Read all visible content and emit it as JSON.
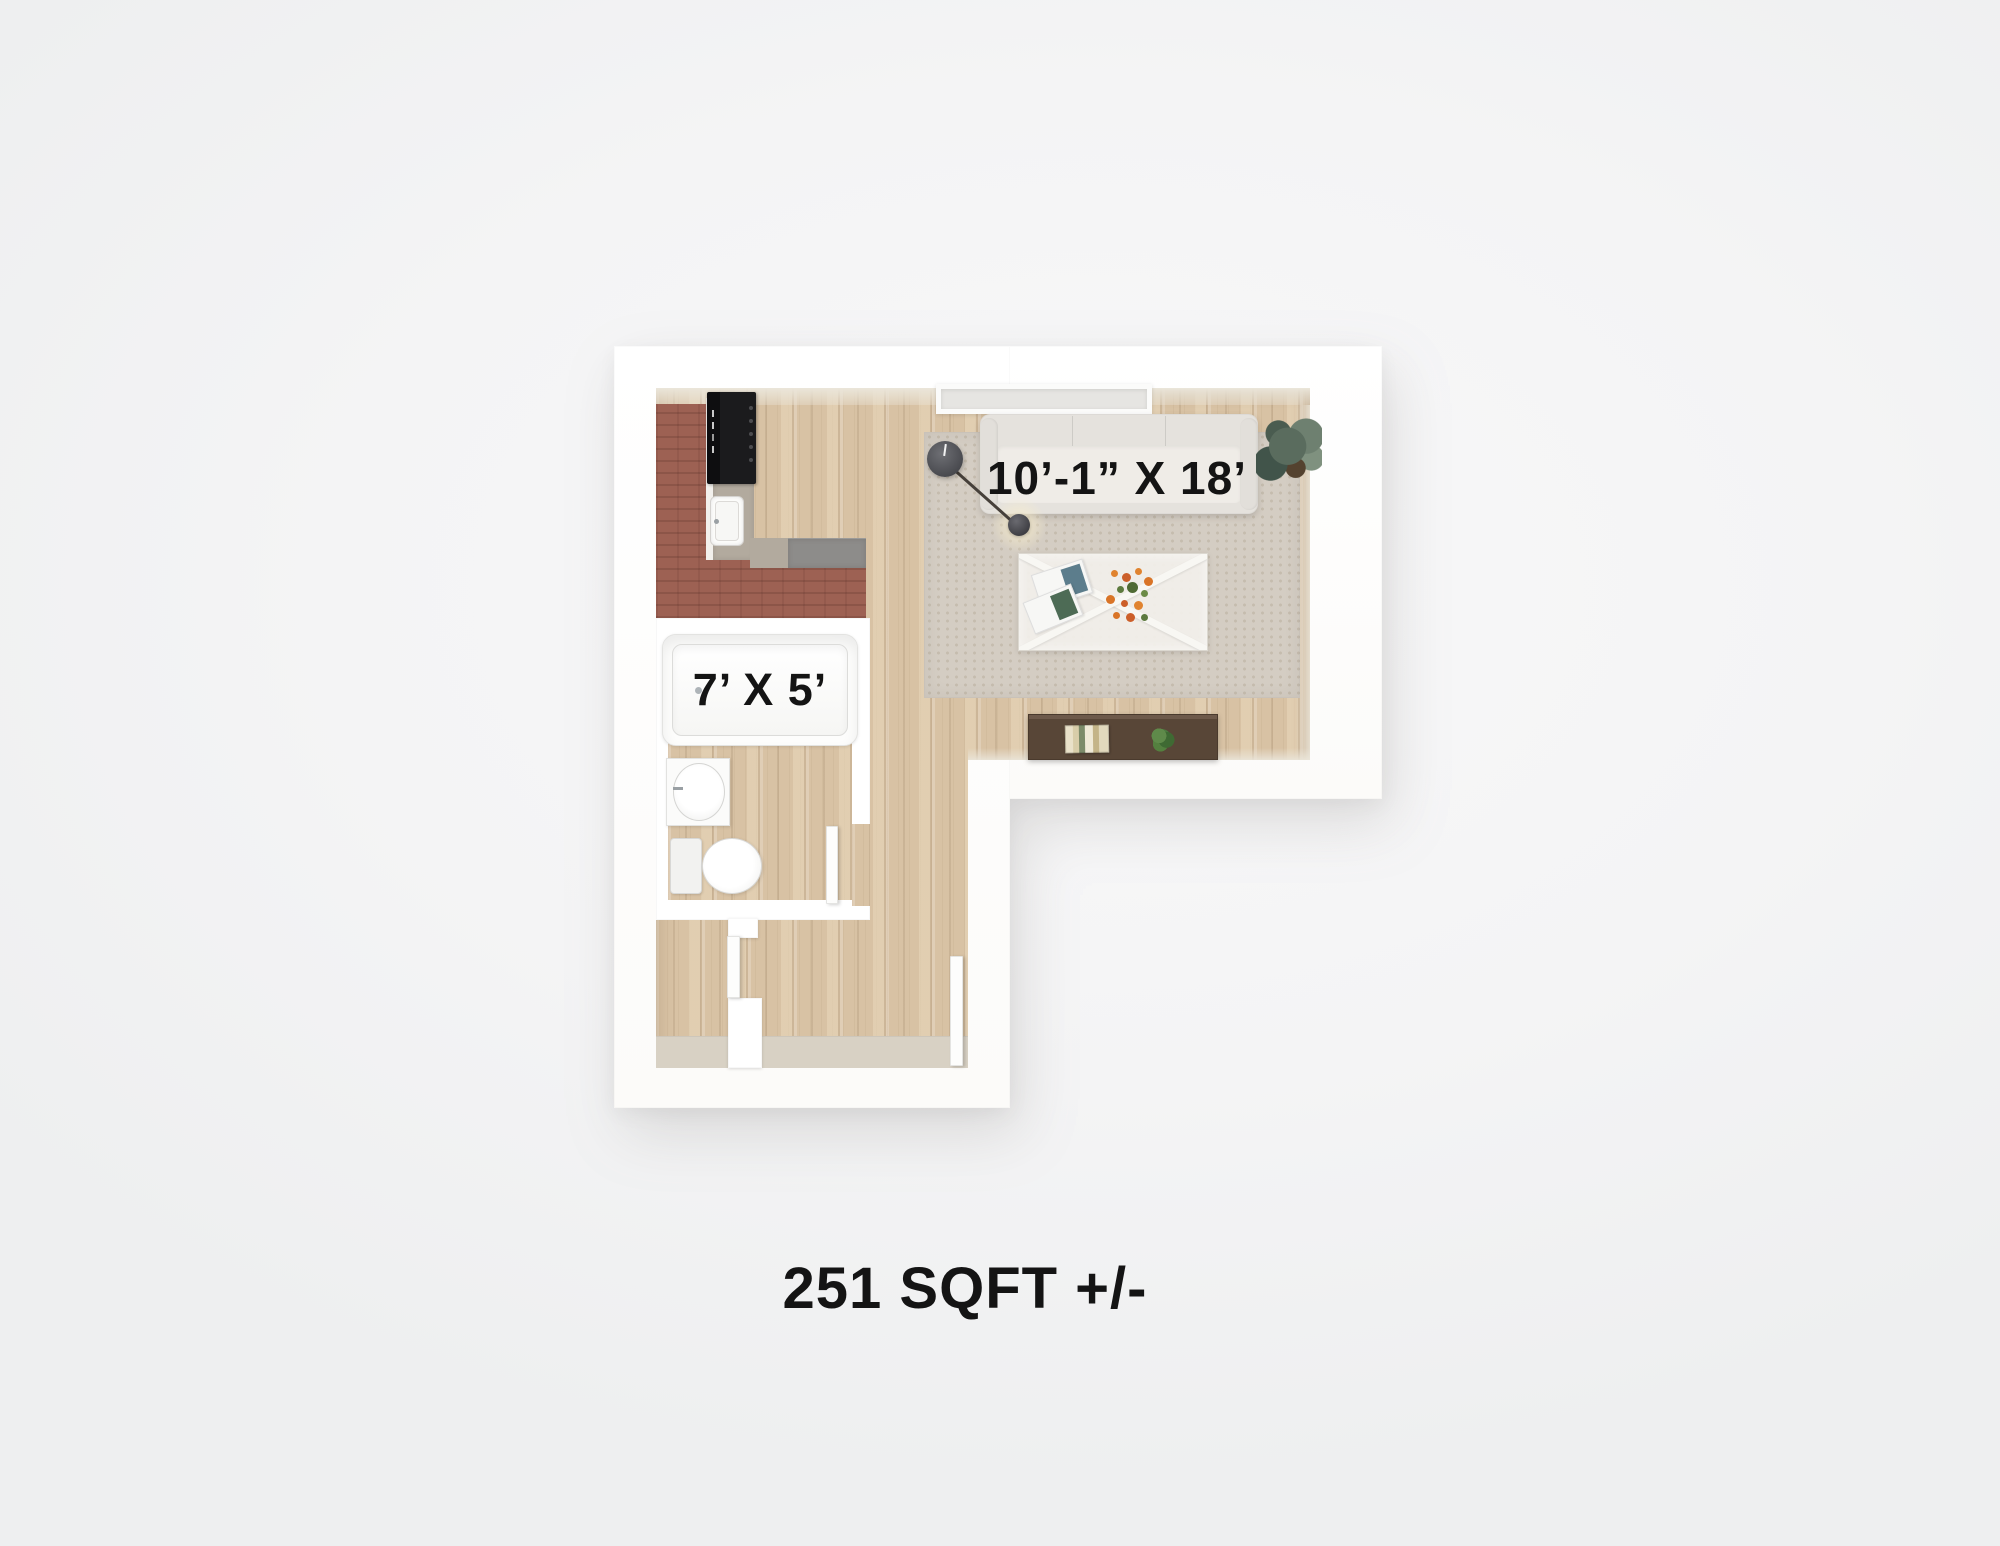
{
  "area_label": "251 SQFT +/-",
  "rooms": {
    "living": {
      "name": "living-room",
      "dimension": "10’-1” X 18’"
    },
    "bathroom": {
      "name": "bathroom",
      "dimension": "7’ X 5’"
    },
    "kitchen": {
      "name": "kitchen"
    },
    "entry": {
      "name": "entry-hall"
    }
  },
  "fixtures": {
    "kitchen": [
      "stove",
      "kitchen-sink",
      "counter",
      "step-landing"
    ],
    "bathroom": [
      "bathtub",
      "bathroom-sink",
      "toilet",
      "bathroom-door"
    ],
    "living": [
      "window",
      "area-rug",
      "sofa",
      "floor-lamp",
      "coffee-table",
      "magazines",
      "flower-bouquet",
      "console-table",
      "books",
      "potted-plant",
      "corner-plant"
    ],
    "entry": [
      "entry-door",
      "closet-door",
      "vestibule-wall"
    ]
  },
  "colors": {
    "wall": "#ffffff",
    "wall_face": "#ebe6da",
    "wood": "#d8c2a4",
    "brick": "#9d6153",
    "counter": "#b2aa9e",
    "landing": "#8d8c8a",
    "rug": "#d4cdc3",
    "rug_dot": "#c5bcae",
    "sofa": "#e5e2dd",
    "sofa_seat": "#efece7",
    "console": "#584637",
    "console_edge": "#6d594a",
    "entry_strip": "#d8d1c4",
    "flower": "#e0832f",
    "plant": "#4c7a3f",
    "lamp": "#54555a",
    "text": "#141414",
    "background": "#f4f4f5"
  }
}
